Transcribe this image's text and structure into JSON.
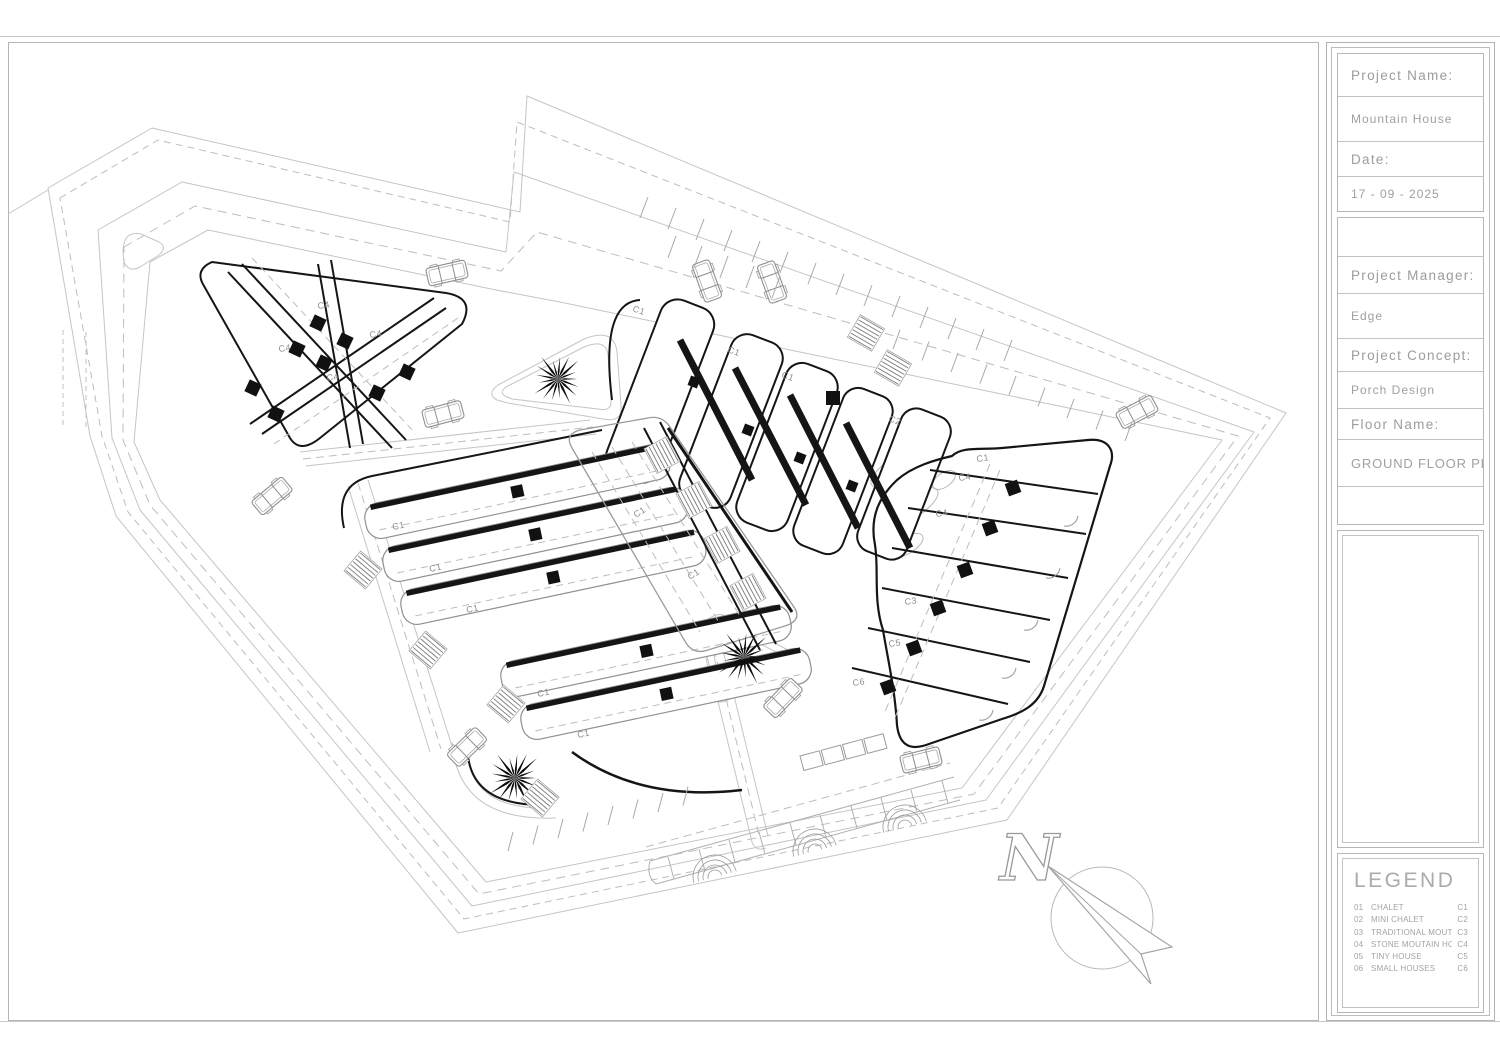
{
  "title_block": {
    "project_name_label": "Project Name:",
    "project_name": "Mountain House",
    "date_label": "Date:",
    "date": "17 - 09 - 2025",
    "project_manager_label": "Project Manager:",
    "project_manager": "Edge",
    "project_concept_label": "Project Concept:",
    "project_concept": "Porch Design",
    "floor_name_label": "Floor Name:",
    "floor_name": "GROUND FLOOR PLAN"
  },
  "legend": {
    "title": "LEGEND",
    "items": [
      {
        "num": "01",
        "name": "CHALET",
        "code": "C1"
      },
      {
        "num": "02",
        "name": "MINI CHALET",
        "code": "C2"
      },
      {
        "num": "03",
        "name": "TRADITIONAL MOUTAIN HOUSE",
        "code": "C3"
      },
      {
        "num": "04",
        "name": "STONE MOUTAIN HOUSE",
        "code": "C4"
      },
      {
        "num": "05",
        "name": "TINY HOUSE",
        "code": "C5"
      },
      {
        "num": "06",
        "name": "SMALL HOUSES",
        "code": "C6"
      }
    ]
  },
  "north_arrow": {
    "letter": "N"
  },
  "plan": {
    "unit_labels": [
      {
        "t": "C4",
        "x": 318,
        "y": 309,
        "r": -8
      },
      {
        "t": "C4",
        "x": 370,
        "y": 338,
        "r": -8
      },
      {
        "t": "C4",
        "x": 279,
        "y": 352,
        "r": -8
      },
      {
        "t": "C4",
        "x": 327,
        "y": 381,
        "r": -8
      },
      {
        "t": "C1",
        "x": 632,
        "y": 311,
        "r": 20
      },
      {
        "t": "C1",
        "x": 727,
        "y": 352,
        "r": 20
      },
      {
        "t": "C1",
        "x": 781,
        "y": 377,
        "r": 20
      },
      {
        "t": "C2",
        "x": 888,
        "y": 421,
        "r": 20
      },
      {
        "t": "C1",
        "x": 977,
        "y": 462,
        "r": -8
      },
      {
        "t": "C4",
        "x": 959,
        "y": 481,
        "r": -8
      },
      {
        "t": "C4",
        "x": 936,
        "y": 517,
        "r": -8
      },
      {
        "t": "C3",
        "x": 905,
        "y": 605,
        "r": -8
      },
      {
        "t": "C5",
        "x": 889,
        "y": 647,
        "r": -8
      },
      {
        "t": "C6",
        "x": 853,
        "y": 686,
        "r": -8
      },
      {
        "t": "C1",
        "x": 393,
        "y": 530,
        "r": -12
      },
      {
        "t": "C1",
        "x": 430,
        "y": 572,
        "r": -12
      },
      {
        "t": "C1",
        "x": 467,
        "y": 613,
        "r": -12
      },
      {
        "t": "C1",
        "x": 538,
        "y": 697,
        "r": -12
      },
      {
        "t": "C1",
        "x": 578,
        "y": 738,
        "r": -12
      },
      {
        "t": "C1",
        "x": 636,
        "y": 518,
        "r": -33
      },
      {
        "t": "C1",
        "x": 690,
        "y": 580,
        "r": -33
      }
    ],
    "squares": [
      [
        318,
        323,
        13,
        25
      ],
      [
        345,
        341,
        13,
        25
      ],
      [
        297,
        349,
        13,
        25
      ],
      [
        324,
        363,
        13,
        25
      ],
      [
        407,
        372,
        13,
        25
      ],
      [
        253,
        388,
        13,
        25
      ],
      [
        377,
        393,
        13,
        25
      ],
      [
        276,
        414,
        13,
        25
      ],
      [
        1013,
        488,
        13,
        -20
      ],
      [
        990,
        528,
        13,
        -20
      ],
      [
        965,
        570,
        13,
        -20
      ],
      [
        938,
        608,
        13,
        -20
      ],
      [
        914,
        648,
        13,
        -20
      ],
      [
        888,
        687,
        13,
        -20
      ],
      [
        694,
        382,
        10,
        21
      ],
      [
        748,
        430,
        10,
        21
      ],
      [
        800,
        458,
        10,
        21
      ],
      [
        852,
        486,
        10,
        21
      ],
      [
        833,
        398,
        14,
        0
      ]
    ],
    "palms": [
      [
        558,
        379,
        27
      ],
      [
        744,
        657,
        29
      ],
      [
        515,
        778,
        29
      ]
    ],
    "cars": [
      [
        447,
        273,
        -13
      ],
      [
        707,
        281,
        70
      ],
      [
        772,
        282,
        70
      ],
      [
        443,
        414,
        -15
      ],
      [
        1137,
        412,
        -28
      ],
      [
        272,
        496,
        -40
      ],
      [
        467,
        747,
        -44
      ],
      [
        783,
        698,
        -46
      ],
      [
        921,
        760,
        -14
      ]
    ],
    "hatches": [
      [
        662,
        455,
        62
      ],
      [
        694,
        500,
        62
      ],
      [
        722,
        545,
        62
      ],
      [
        748,
        592,
        62
      ],
      [
        363,
        570,
        40
      ],
      [
        428,
        650,
        40
      ],
      [
        506,
        704,
        40
      ],
      [
        540,
        798,
        40
      ],
      [
        866,
        333,
        30
      ],
      [
        893,
        368,
        30
      ]
    ],
    "parking_rows": [
      {
        "sx": 640,
        "sy": 218,
        "dx": 28,
        "dy": 11,
        "tx": 8,
        "ty": -21,
        "n": 14
      },
      {
        "sx": 893,
        "sy": 349,
        "dx": 29,
        "dy": 11.5,
        "tx": 7,
        "ty": -19,
        "n": 9
      },
      {
        "sx": 508,
        "sy": 851,
        "dx": 25,
        "dy": -6.5,
        "tx": 5,
        "ty": -19,
        "n": 8
      },
      {
        "sx": 668,
        "sy": 258,
        "dx": 26,
        "dy": 10,
        "tx": 8,
        "ty": -22,
        "n": 5
      }
    ],
    "arc_fans": [
      [
        715,
        877,
        -15
      ],
      [
        815,
        851,
        -15
      ],
      [
        905,
        827,
        -15
      ]
    ]
  }
}
